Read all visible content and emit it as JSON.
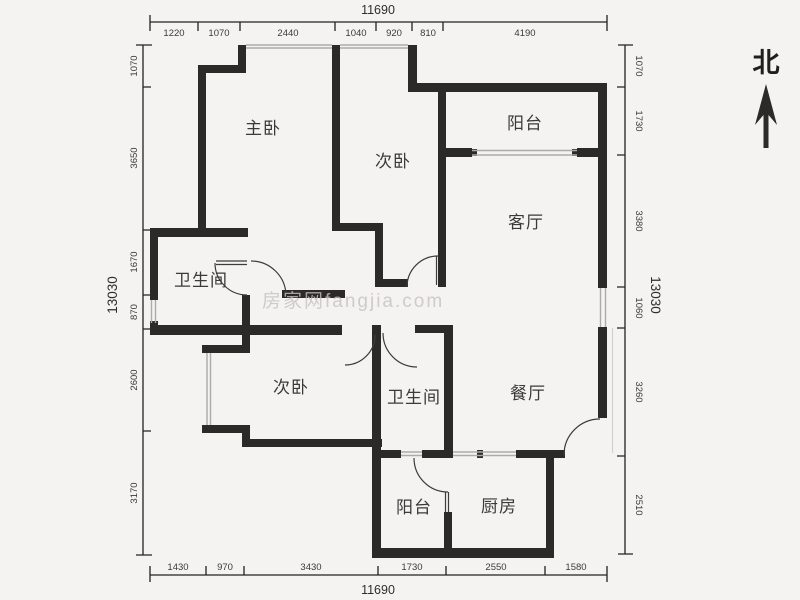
{
  "compass": {
    "label": "北"
  },
  "watermark": {
    "text": "房家网fangjia.com"
  },
  "rooms": {
    "master_bedroom": "主卧",
    "bedroom_top": "次卧",
    "balcony_top": "阳台",
    "living_room": "客厅",
    "bathroom_top": "卫生间",
    "bedroom_bottom": "次卧",
    "bathroom_bottom": "卫生间",
    "dining_room": "餐厅",
    "balcony_bottom": "阳台",
    "kitchen": "厨房"
  },
  "dimensions": {
    "top": {
      "total": "11690",
      "segments": [
        "1220",
        "1070",
        "2440",
        "1040",
        "920",
        "810",
        "4190"
      ]
    },
    "bottom": {
      "total": "11690",
      "segments": [
        "1430",
        "970",
        "3430",
        "1730",
        "2550",
        "1580"
      ]
    },
    "left": {
      "total": "13030",
      "segments": [
        "1070",
        "3650",
        "1670",
        "870",
        "2600",
        "3170"
      ]
    },
    "right": {
      "total": "13030",
      "segments": [
        "1070",
        "1730",
        "3380",
        "1060",
        "3260",
        "2510"
      ]
    }
  },
  "colors": {
    "background": "#f4f3f1",
    "wall": "#2b2a28",
    "dimension_line": "#222222",
    "window": "#ababab"
  }
}
